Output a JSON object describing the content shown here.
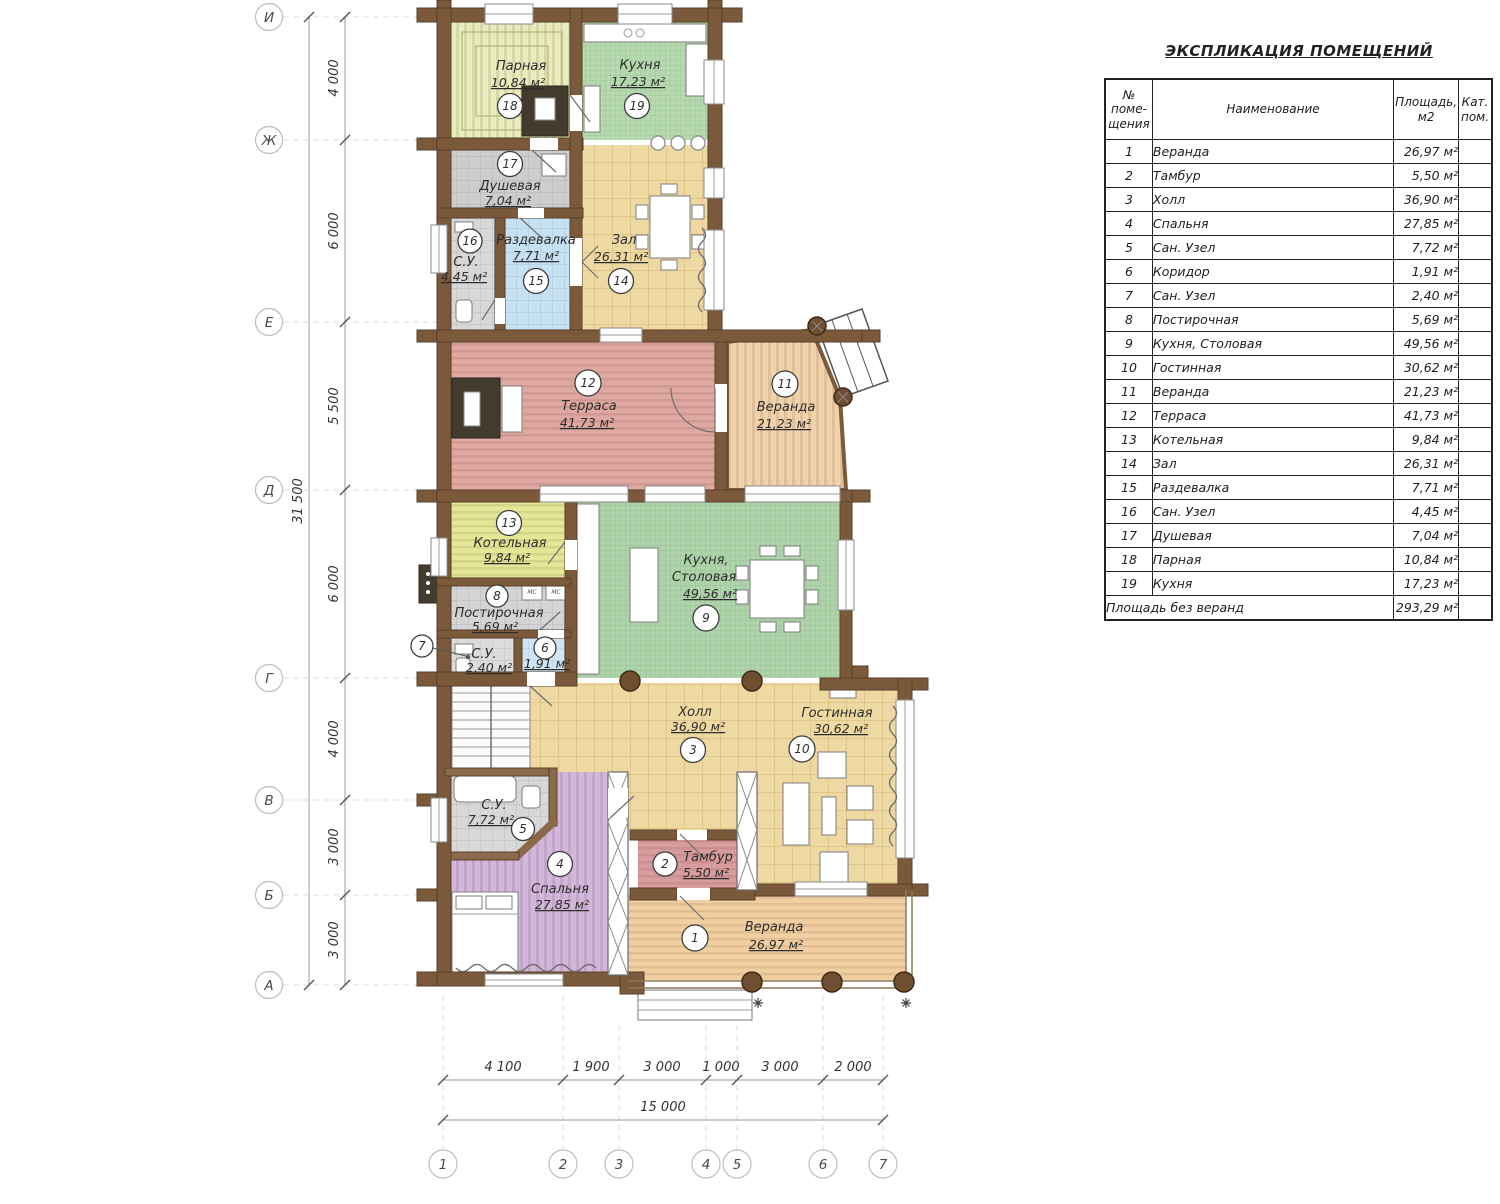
{
  "title": "ЭКСПЛИКАЦИЯ ПОМЕЩЕНИЙ",
  "table": {
    "headers": [
      "№\nпоме-\nщения",
      "Наименование",
      "Площадь,\nм2",
      "Кат.\nпом."
    ],
    "footer_label": "Площадь без веранд",
    "footer_area": "293,29 м²"
  },
  "plan": {
    "washer_label": "МС",
    "rooms": [
      {
        "num": "1",
        "name": "Веранда",
        "plan_name": "Веранда",
        "area": "26,97 м²",
        "color": "#f1cfa0"
      },
      {
        "num": "2",
        "name": "Тамбур",
        "plan_name": "Тамбур",
        "area": "5,50 м²",
        "color": "#d99c9c"
      },
      {
        "num": "3",
        "name": "Холл",
        "plan_name": "Холл",
        "area": "36,90 м²",
        "color": "#eed9a2"
      },
      {
        "num": "4",
        "name": "Спальня",
        "plan_name": "Спальня",
        "area": "27,85 м²",
        "color": "#d3b7da"
      },
      {
        "num": "5",
        "name": "Сан. Узел",
        "plan_name": "С.У.",
        "area": "7,72 м²",
        "color": "#d8d8d8"
      },
      {
        "num": "6",
        "name": "Коридор",
        "plan_name": "",
        "area": "1,91 м²",
        "color": "#cfe5f4"
      },
      {
        "num": "7",
        "name": "Сан. Узел",
        "plan_name": "С.У.",
        "area": "2,40 м²",
        "color": "#dcdcdc"
      },
      {
        "num": "8",
        "name": "Постирочная",
        "plan_name": "Постирочная",
        "area": "5,69 м²",
        "color": "#d4d4d4"
      },
      {
        "num": "9",
        "name": "Кухня, Столовая",
        "plan_name": "Кухня, Столовая",
        "plan_lines": [
          "Кухня,",
          "Столовая"
        ],
        "area": "49,56 м²",
        "color": "#afd3aa"
      },
      {
        "num": "10",
        "name": "Гостинная",
        "plan_name": "Гостинная",
        "area": "30,62 м²",
        "color": "#eed9a2"
      },
      {
        "num": "11",
        "name": "Веранда",
        "plan_name": "Веранда",
        "area": "21,23 м²",
        "color": "#f2d2a8"
      },
      {
        "num": "12",
        "name": "Терраса",
        "plan_name": "Терраса",
        "area": "41,73 м²",
        "color": "#dfa8a1"
      },
      {
        "num": "13",
        "name": "Котельная",
        "plan_name": "Котельная",
        "area": "9,84 м²",
        "color": "#e4e896"
      },
      {
        "num": "14",
        "name": "Зал",
        "plan_name": "Зал",
        "area": "26,31 м²",
        "color": "#eed9a2"
      },
      {
        "num": "15",
        "name": "Раздевалка",
        "plan_name": "Раздевалка",
        "area": "7,71 м²",
        "color": "#c5e1f2"
      },
      {
        "num": "16",
        "name": "Сан. Узел",
        "plan_name": "С.У.",
        "area": "4,45 м²",
        "color": "#d8d8d8"
      },
      {
        "num": "17",
        "name": "Душевая",
        "plan_name": "Душевая",
        "area": "7,04 м²",
        "color": "#cdcdcd"
      },
      {
        "num": "18",
        "name": "Парная",
        "plan_name": "Парная",
        "area": "10,84 м²",
        "color": "#e9edbb"
      },
      {
        "num": "19",
        "name": "Кухня",
        "plan_name": "Кухня",
        "area": "17,23 м²",
        "color": "#b6d9b0"
      }
    ],
    "axes_left": [
      "И",
      "Ж",
      "Е",
      "Д",
      "Г",
      "В",
      "Б",
      "А"
    ],
    "dims_left": [
      "4 000",
      "6 000",
      "5 500",
      "6 000",
      "4 000",
      "3 000",
      "3 000"
    ],
    "total_left": "31 500",
    "axes_bottom": [
      "1",
      "2",
      "3",
      "4",
      "5",
      "6",
      "7"
    ],
    "dims_bottom": [
      "4 100",
      "1 900",
      "3 000",
      "1 000",
      "3 000",
      "2 000"
    ],
    "total_bottom": "15 000"
  }
}
